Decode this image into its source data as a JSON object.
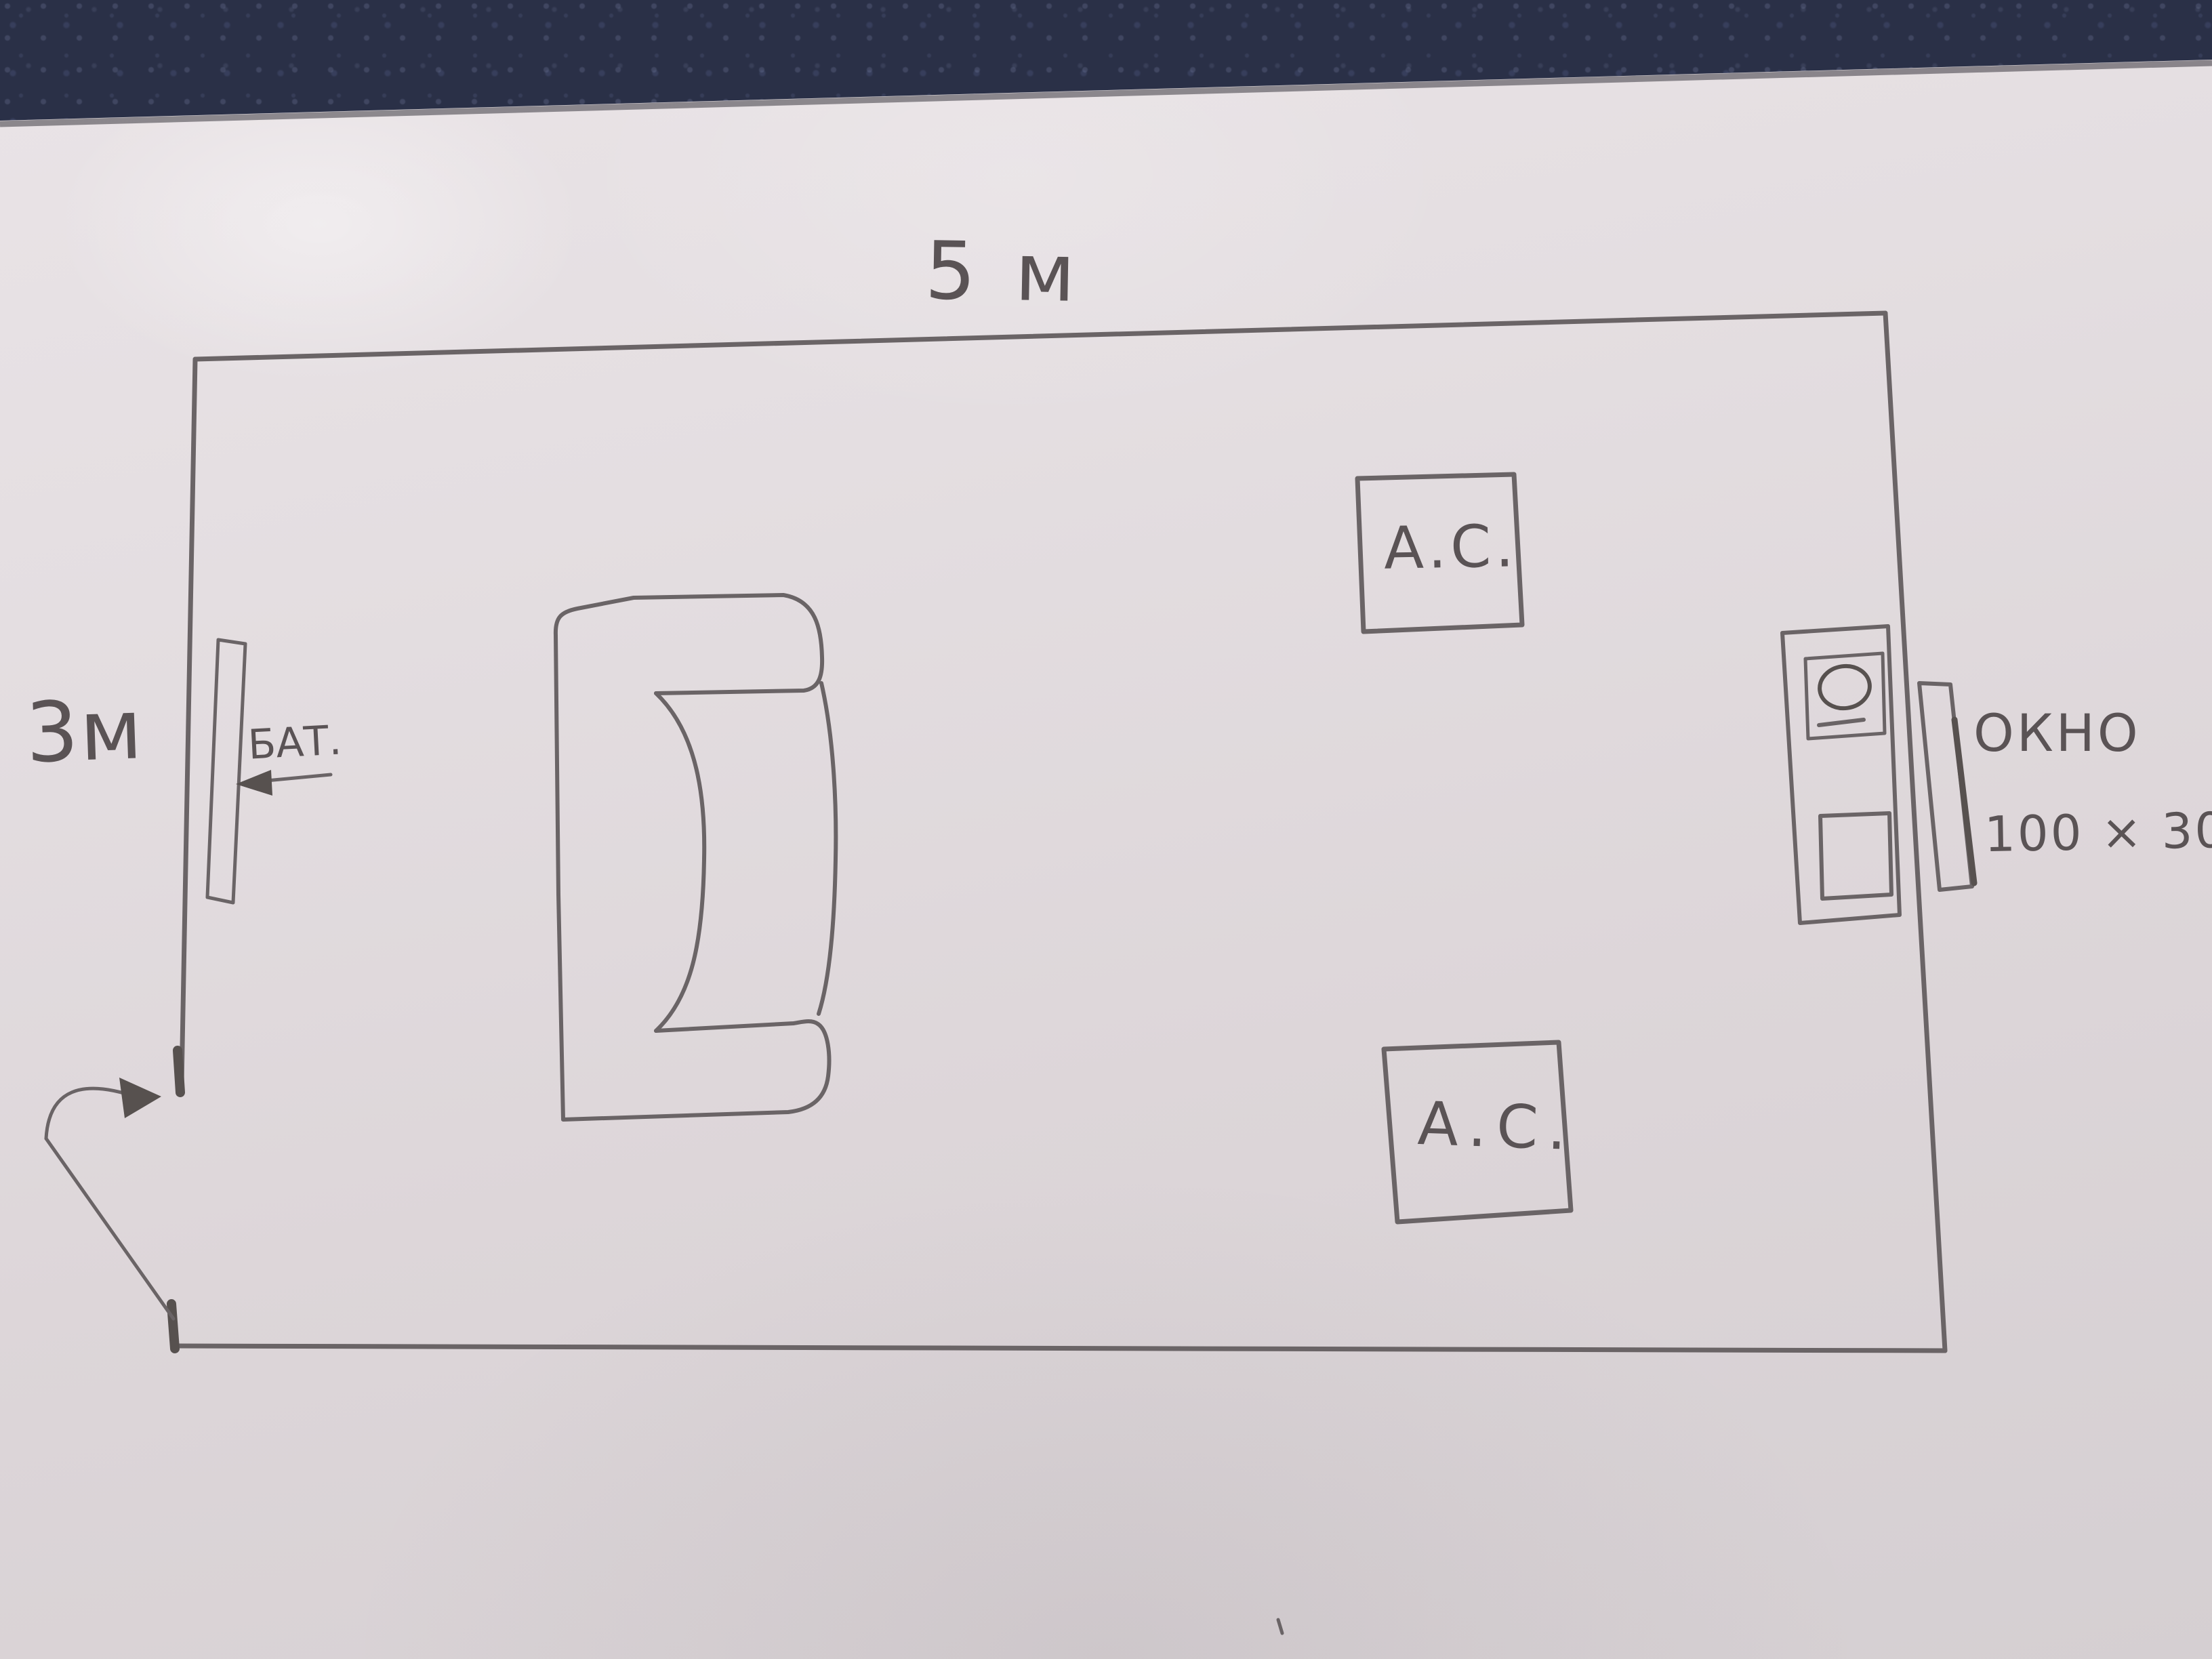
{
  "drawing_title": "Hand-drawn room floor plan sketch",
  "labels": {
    "room_width": "5 м",
    "room_height": "3м",
    "radiator": "БАТ.",
    "window": "ОКНО",
    "window_size": "100 × 30",
    "speaker_top": "А.С.",
    "speaker_bottom": "А.С."
  },
  "room": {
    "width_meters": 5,
    "height_meters": 3,
    "window_dimensions": "100 × 30",
    "objects": [
      "radiator",
      "sofa",
      "speaker-box",
      "speaker-box",
      "tv-stand",
      "window",
      "door-swing"
    ]
  },
  "colors": {
    "leather": "#2a3047",
    "paper": "#e3dcdf",
    "pencil": "#6a6466",
    "pencil_dark": "#57514f",
    "text": "#5a5355"
  }
}
